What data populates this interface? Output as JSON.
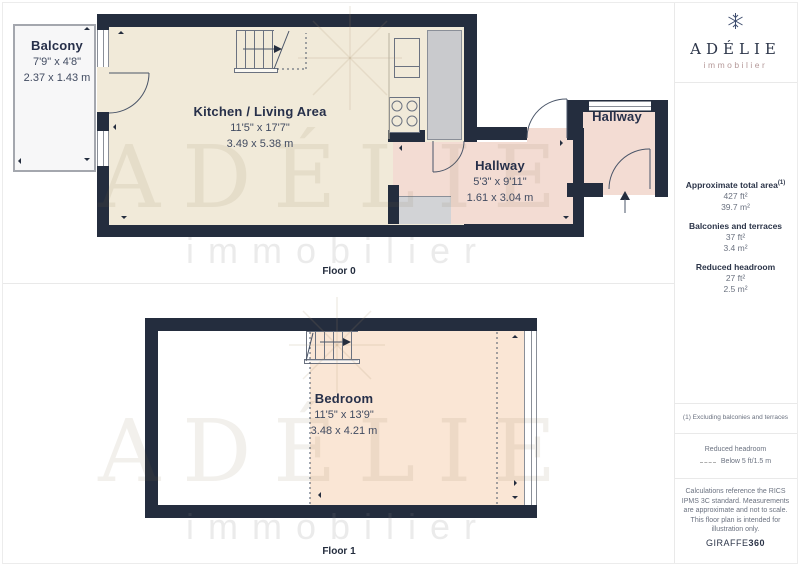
{
  "brand": {
    "name": "ADÉLIE",
    "tagline": "immobilier"
  },
  "floors": {
    "floor0": {
      "label": "Floor 0",
      "balcony": {
        "name": "Balcony",
        "imperial": "7'9\" x 4'8\"",
        "metric": "2.37 x 1.43 m"
      },
      "kitchen": {
        "name": "Kitchen / Living Area",
        "imperial": "11'5\" x 17'7\"",
        "metric": "3.49 x 5.38 m"
      },
      "hallway": {
        "name": "Hallway",
        "imperial": "5'3\" x 9'11\"",
        "metric": "1.61 x 3.04 m"
      },
      "hallway2": {
        "name": "Hallway"
      }
    },
    "floor1": {
      "label": "Floor 1",
      "bedroom": {
        "name": "Bedroom",
        "imperial": "11'5\" x 13'9\"",
        "metric": "3.48 x 4.21 m"
      }
    }
  },
  "panel": {
    "total_area": {
      "label": "Approximate total area",
      "sup": "(1)",
      "imperial": "427 ft²",
      "metric": "39.7 m²"
    },
    "balconies": {
      "label": "Balconies and terraces",
      "imperial": "37 ft²",
      "metric": "3.4 m²"
    },
    "reduced_headroom": {
      "label": "Reduced headroom",
      "imperial": "27 ft²",
      "metric": "2.5 m²"
    },
    "note": "(1) Excluding balconies and terraces",
    "legend": {
      "title": "Reduced headroom",
      "dash_label": "Below 5 ft/1.5 m"
    },
    "disclaimer": "Calculations reference the RICS IPMS 3C standard. Measurements are approximate and not to scale. This floor plan is intended for illustration only.",
    "credit": {
      "brand": "GIRAFFE",
      "suffix": "360"
    }
  },
  "colors": {
    "wall": "#242d3e",
    "kitchen_floor": "#f1ead9",
    "hallway_floor": "#f3dcd3",
    "bedroom_floor": "#fae6d5",
    "shaft": "#c9cacd",
    "balcony_fill": "#f7f7f8",
    "text_dark": "#27304a",
    "text_muted": "#6b7280",
    "logo_tagline": "#b49898"
  }
}
